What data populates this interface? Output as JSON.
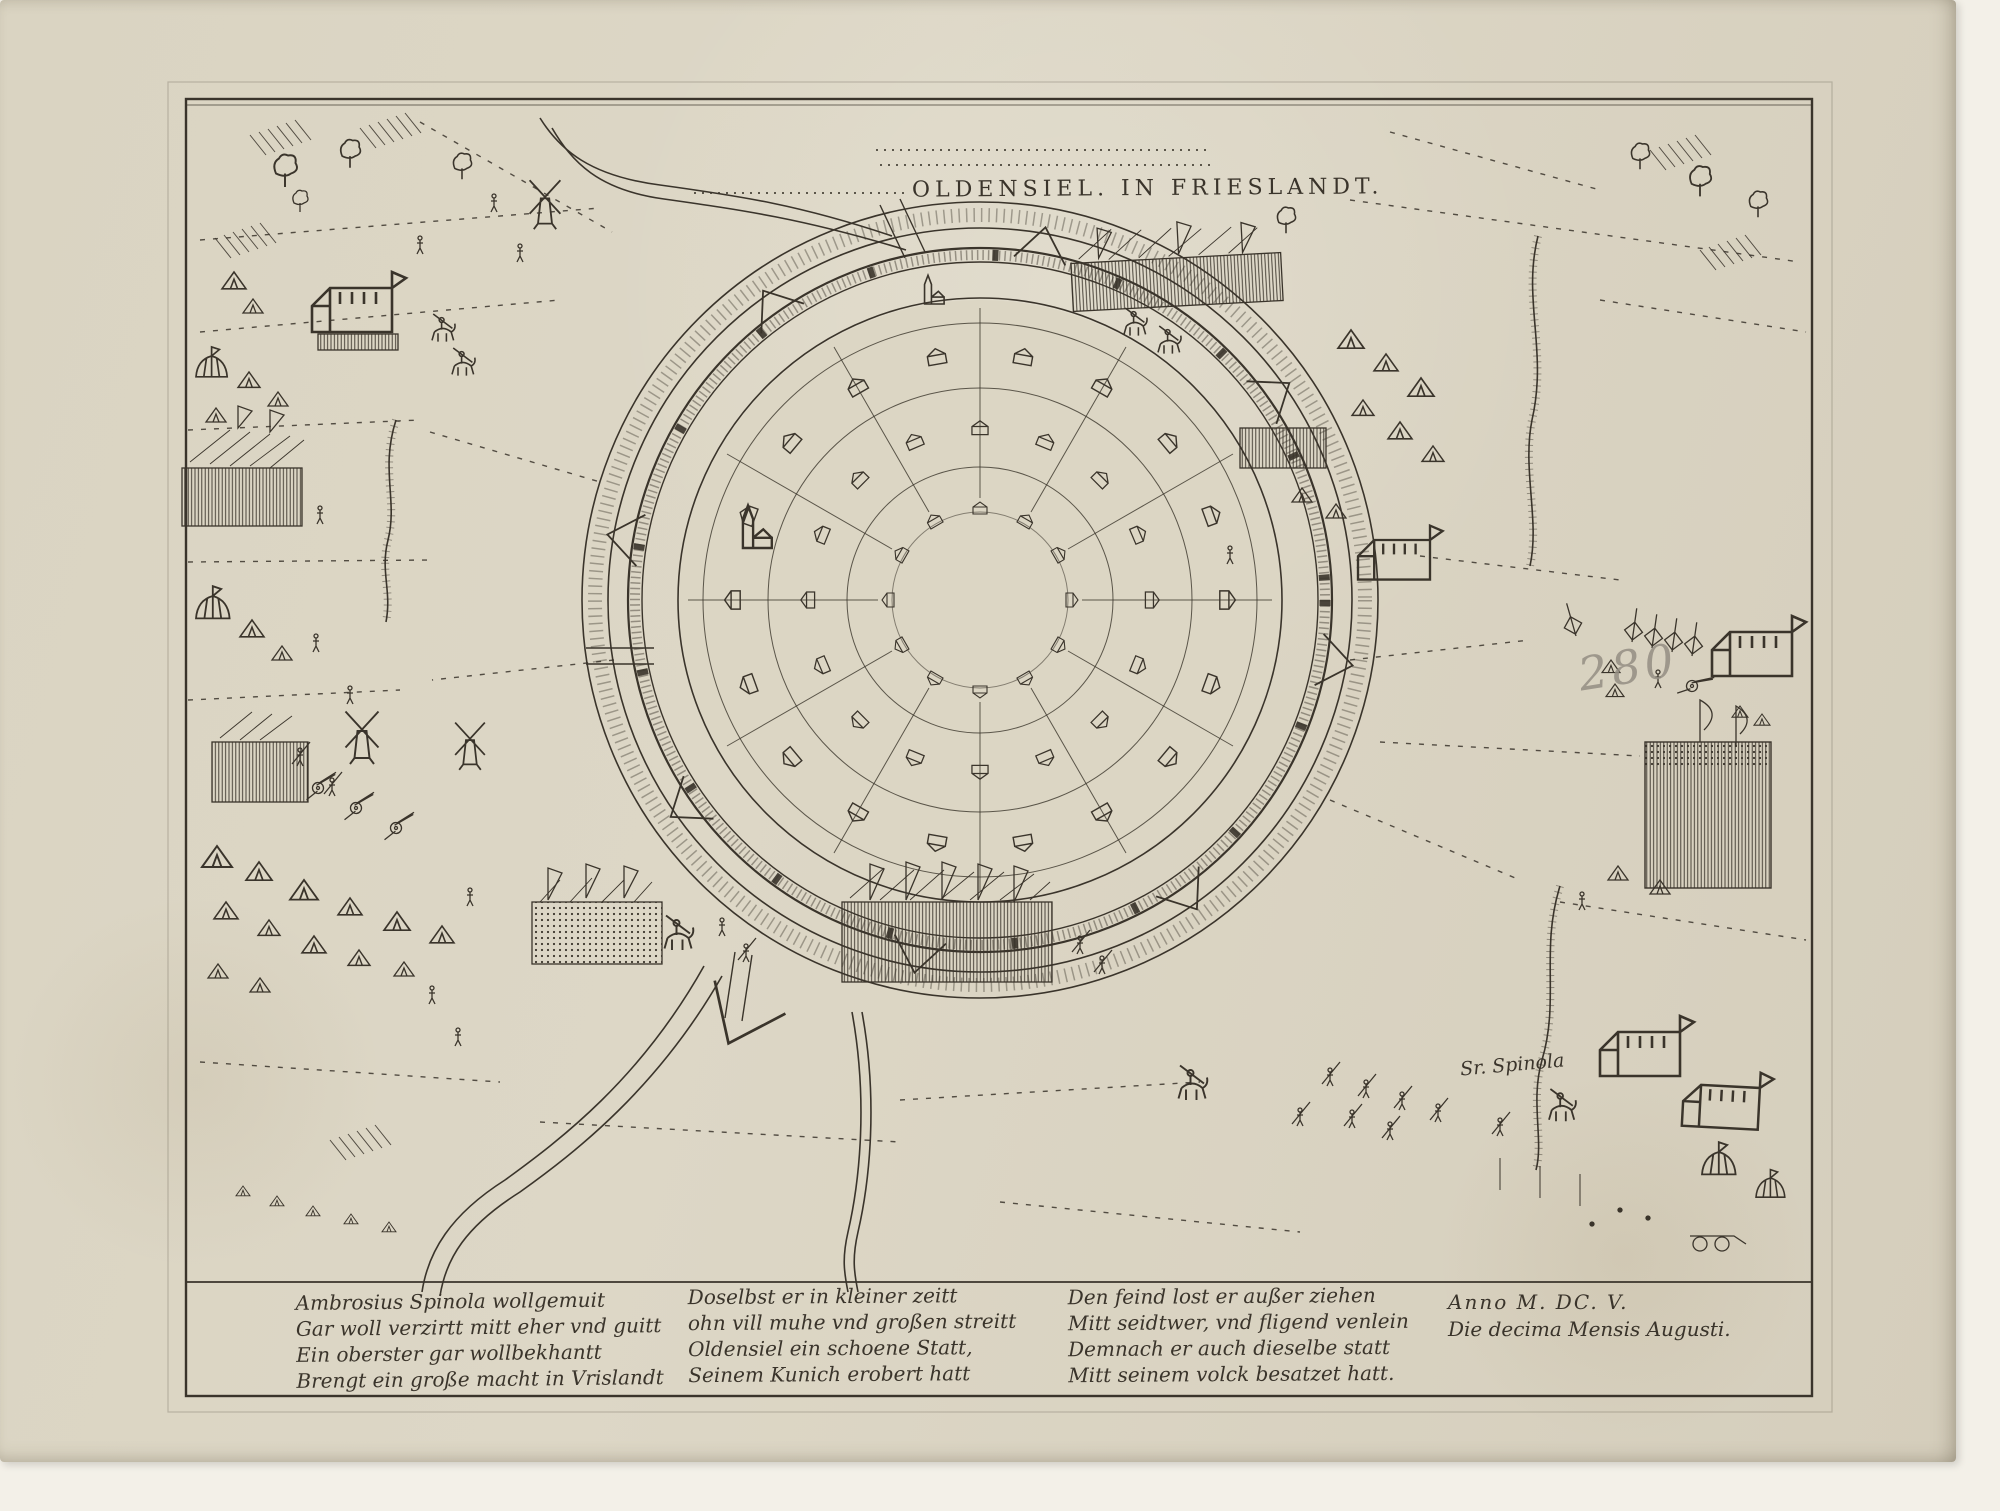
{
  "artwork": {
    "title": "OLDENSIEL. IN FRIESLANDT.",
    "labels": {
      "spinola": "Sr. Spinola"
    },
    "inscriptions": {
      "pencil_number": "280"
    },
    "verses": [
      {
        "lines": [
          "Ambrosius Spinola wollgemuit",
          "Gar woll verzirtt mitt eher vnd guitt",
          "Ein oberster gar wollbekhantt",
          "Brengt ein große macht in Vrislandt"
        ]
      },
      {
        "lines": [
          "Doselbst er in kleiner zeitt",
          "ohn vill muhe vnd großen streitt",
          "Oldensiel ein schoene Statt,",
          "Seinem Kunich erobert hatt"
        ]
      },
      {
        "lines": [
          "Den feind lost er außer ziehen",
          "Mitt seidtwer, vnd fligend venlein",
          "Demnach er auch dieselbe statt",
          "Mitt seinem volck besatzet hatt."
        ]
      }
    ],
    "colophon": {
      "line1": "Anno M. DC. V.",
      "line2": "Die decima Mensis Augusti."
    },
    "colors": {
      "paper": "#dad4c2",
      "ink": "#3a342b",
      "pencil": "#948e83",
      "backing": "#f3f0e8"
    }
  }
}
